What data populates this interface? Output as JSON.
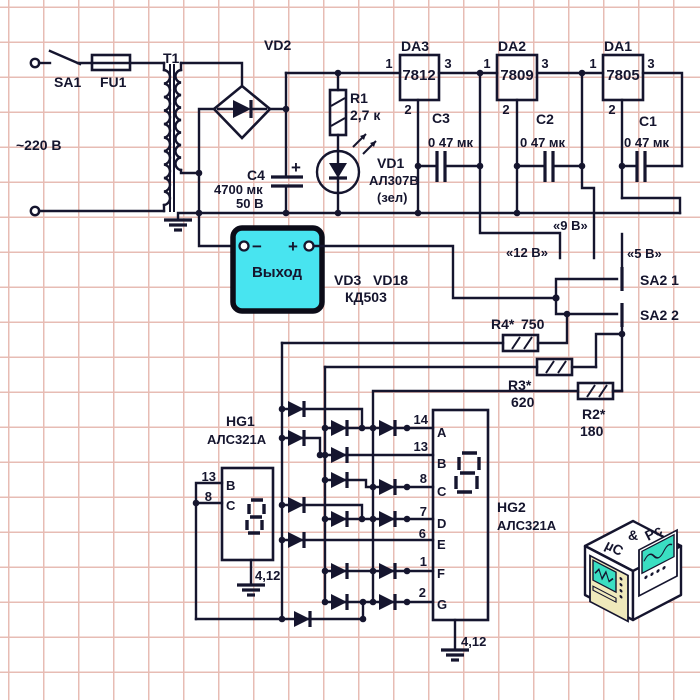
{
  "schematic": {
    "input": {
      "switch": "SA1",
      "fuse": "FU1",
      "transformer": "Т1",
      "mains_voltage": "~220 В"
    },
    "bridge": {
      "name": "VD2"
    },
    "filter_cap": {
      "name": "C4",
      "value": "4700 мк",
      "voltage": "50 В",
      "polarity": "+"
    },
    "led_branch": {
      "resistor": "R1",
      "resistor_value": "2,7 к",
      "led": "VD1",
      "led_type": "АЛ307В",
      "led_color": "(зел)"
    },
    "regulators": [
      {
        "name": "DA3",
        "chip": "7812",
        "pin_in": "1",
        "pin_gnd": "2",
        "pin_out": "3"
      },
      {
        "name": "DA2",
        "chip": "7809",
        "pin_in": "1",
        "pin_gnd": "2",
        "pin_out": "3"
      },
      {
        "name": "DA1",
        "chip": "7805",
        "pin_in": "1",
        "pin_gnd": "2",
        "pin_out": "3"
      }
    ],
    "output_caps": [
      {
        "name": "C3",
        "value": "0 47 мк"
      },
      {
        "name": "C2",
        "value": "0 47 мк"
      },
      {
        "name": "C1",
        "value": "0 47 мк"
      }
    ],
    "voltage_taps": {
      "v12": "«12 В»",
      "v9": "«9 В»",
      "v5": "«5 В»"
    },
    "output_block": {
      "label": "Выход",
      "minus": "−",
      "plus": "+"
    },
    "matrix_diodes": {
      "first": "VD3",
      "last": "VD18",
      "type": "КД503"
    },
    "selector": {
      "contact1": "SA2 1",
      "contact2": "SA2 2"
    },
    "set_resistors": [
      {
        "name": "R4*",
        "value": "750"
      },
      {
        "name": "R3*",
        "value": "620"
      },
      {
        "name": "R2*",
        "value": "180"
      }
    ],
    "hg1": {
      "name": "HG1",
      "type": "АЛС321А",
      "pin_b": "13",
      "pin_c": "8",
      "seg_b": "B",
      "seg_c": "C",
      "gnd": "4,12"
    },
    "hg2": {
      "name": "HG2",
      "type": "АЛС321А",
      "gnd": "4,12",
      "pins": [
        {
          "num": "14",
          "seg": "A"
        },
        {
          "num": "13",
          "seg": "B"
        },
        {
          "num": "8",
          "seg": "C"
        },
        {
          "num": "7",
          "seg": "D"
        },
        {
          "num": "6",
          "seg": "E"
        },
        {
          "num": "1",
          "seg": "F"
        },
        {
          "num": "2",
          "seg": "G"
        }
      ]
    },
    "logo": {
      "p1": "µC",
      "p2": "&",
      "p3": "Pc"
    },
    "colors": {
      "ink": "#15152e",
      "output_fill": "#48e4f0",
      "grid": "#e7bcb4"
    }
  }
}
